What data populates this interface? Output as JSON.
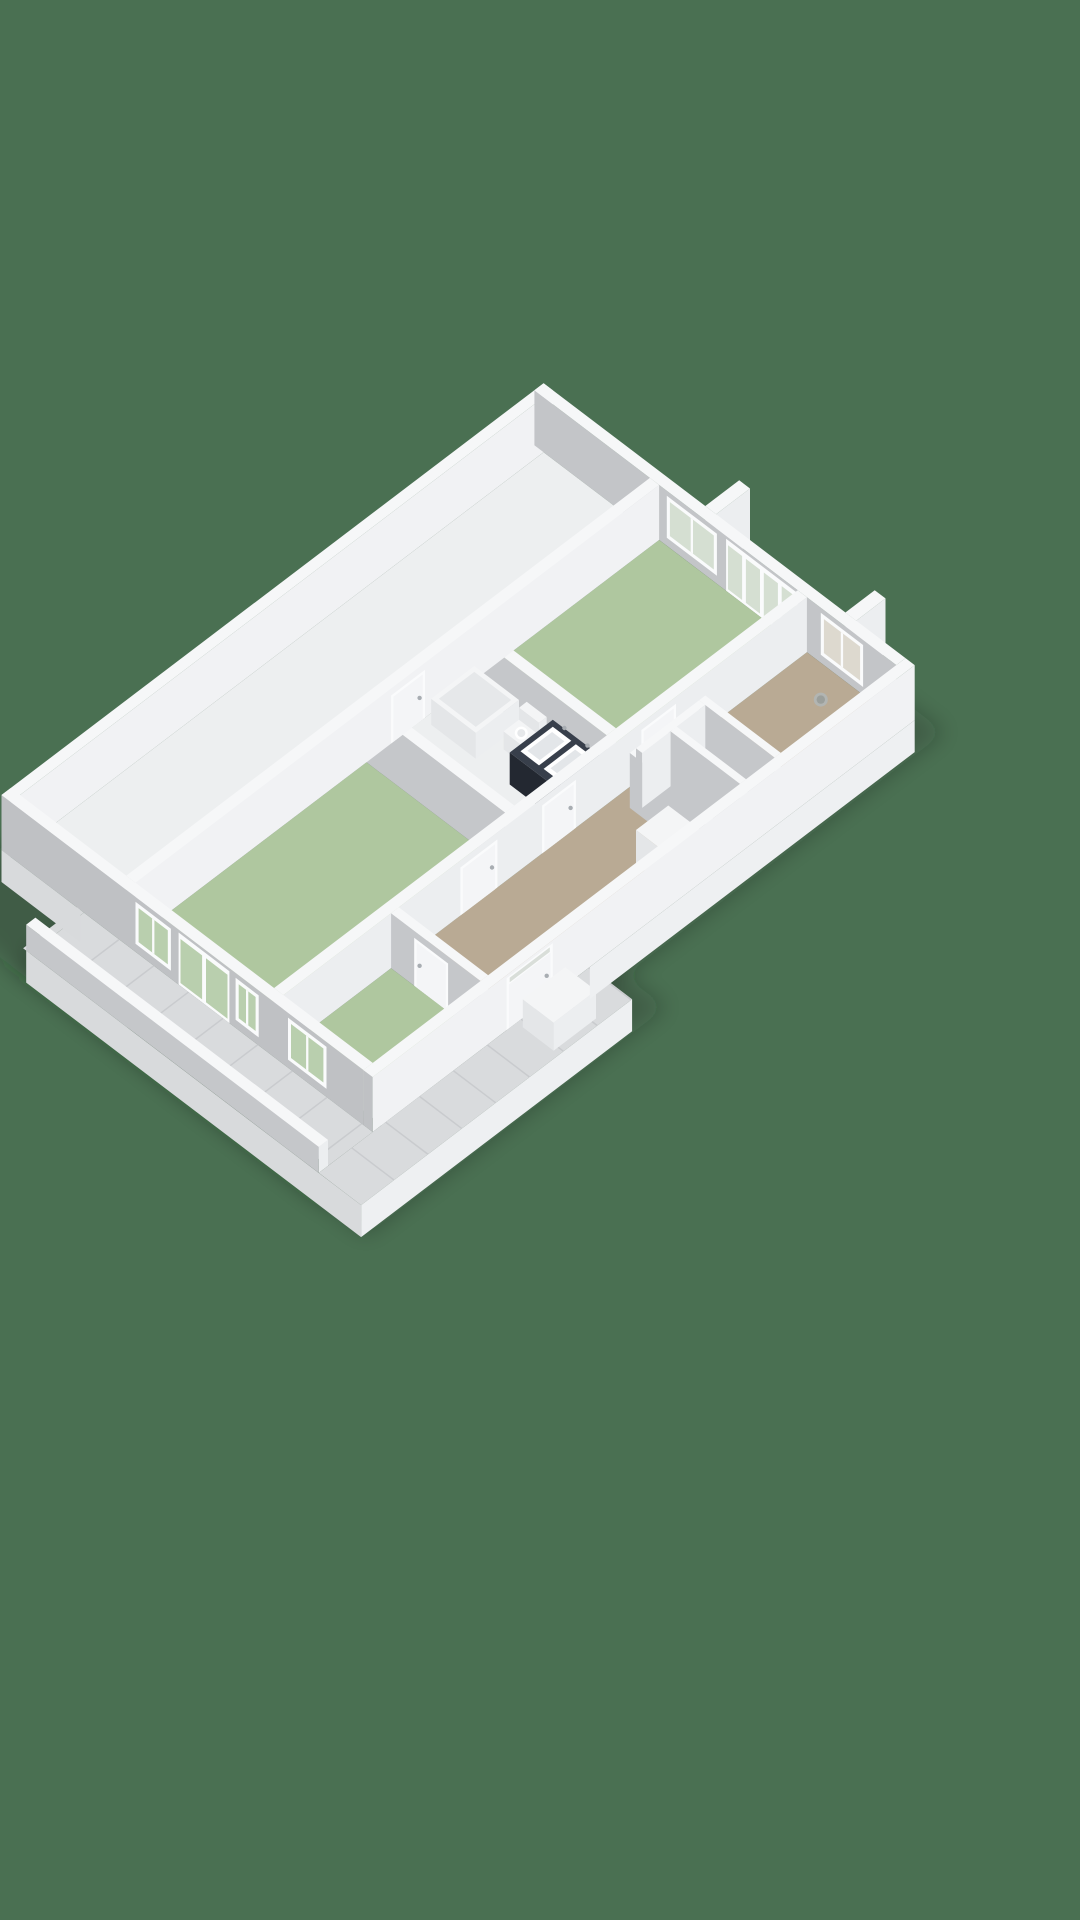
{
  "scene": {
    "description": "3D isometric floor plan rendering of an apartment, viewed from above at an angle, no text labels",
    "background": "#4a7052",
    "palette": {
      "wallTop": "#f6f7f8",
      "faceBright": "#f1f2f4",
      "faceLight": "#eceef0",
      "faceMid": "#c5c7ca",
      "faceGray": "#c3c5c8",
      "faceOuterSW": "#bfc1c4",
      "floorWhite": "#edeff0",
      "floorGreen": "#afc79f",
      "floorBeige": "#b9aa94",
      "floorTile": "#d9dbdd",
      "tileJoint": "#c9cbce",
      "fascia": "#eef0f2",
      "fasciaShade": "#d8dadc",
      "frame": "#fafbfc",
      "glassGreen": "#b9cfae",
      "glassPale": "#d5dfd2",
      "glassBeige": "#ddd9cf",
      "glassTransom": "#d9ded9",
      "vanityTop": "#383f4b",
      "vanityLeft": "#232831",
      "vanityRight": "#2d3440",
      "fixtureTop": "#f4f5f6",
      "fixtureLeft": "#e4e6e8",
      "fixtureRight": "#eceef0",
      "sinkInner": "#e3e6e9",
      "rimInset": "#e6e8ea",
      "metal": "#a8adb2",
      "potGray": "#b2b5b2",
      "potGrayDark": "#9b9f9b",
      "glassScreen": "rgba(200,215,224,0.42)",
      "washerRing": "#d4d7da",
      "washerRingInner": "#c3c7ca",
      "shadow": "rgba(22,40,26,0.25)",
      "doorLeaf": "#f4f5f7"
    },
    "rooms": [
      {
        "id": "bedroom-left",
        "floor": "floorGreen"
      },
      {
        "id": "living-room",
        "floor": "floorGreen"
      },
      {
        "id": "small-room",
        "floor": "floorGreen"
      },
      {
        "id": "bathroom",
        "floor": "floorWhite"
      },
      {
        "id": "hallway",
        "floor": "floorBeige"
      },
      {
        "id": "entry",
        "floor": "floorBeige"
      },
      {
        "id": "closets",
        "floor": "floorWhite"
      },
      {
        "id": "nw-corridor",
        "floor": "floorWhite"
      },
      {
        "id": "gallery-balcony",
        "floor": "floorTile"
      },
      {
        "id": "porch",
        "floor": "floorTile"
      }
    ],
    "fixtures": [
      "bathtub",
      "toilet",
      "vanity-double-sink",
      "glass-shower-screen",
      "washing-machine",
      "storage-bench",
      "plant-pot"
    ],
    "glazing": [
      "living-room-window",
      "living-room-french-doors",
      "entry-window",
      "bedroom-window-1",
      "bedroom-french-doors",
      "bedroom-window-2",
      "small-room-window",
      "front-door-with-transom"
    ]
  }
}
